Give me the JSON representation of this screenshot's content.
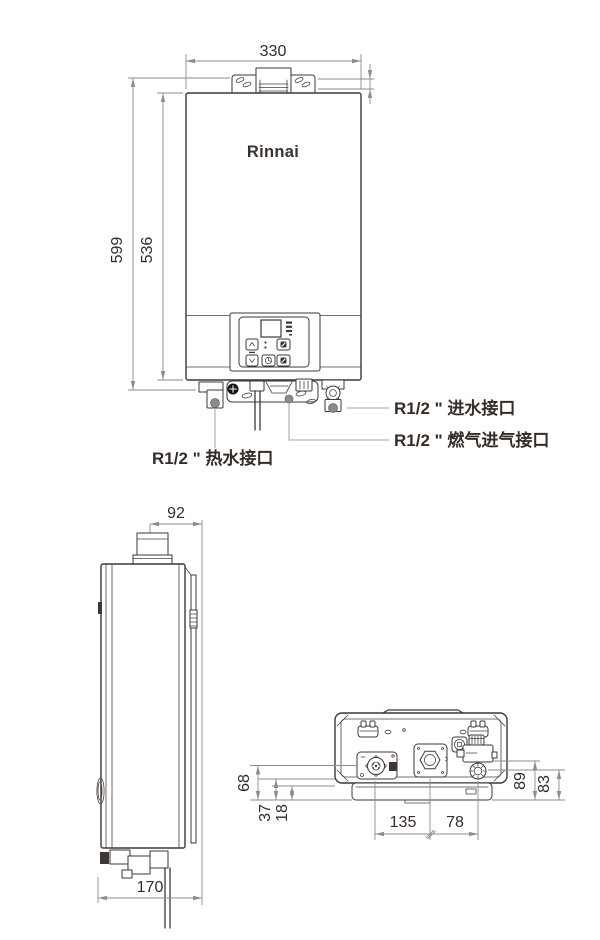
{
  "front": {
    "logo": "Rinnai",
    "dim_width_330": "330",
    "dim_height_599": "599",
    "dim_height_536": "536",
    "dim_top_10": "10",
    "label_inlet": "R1/2 \" 进水接口",
    "label_gas": "R1/2 \" 燃气进气接口",
    "label_hot": "R1/2 \" 热水接口"
  },
  "side": {
    "dim_92": "92",
    "dim_170": "170"
  },
  "bottom": {
    "dim_68": "68",
    "dim_37": "37",
    "dim_18": "18",
    "dim_135": "135",
    "dim_78": "78",
    "dim_89": "89",
    "dim_83": "83"
  },
  "control_panel": {
    "icons": [
      "up-arrow-icon",
      "down-arrow-icon",
      "clock-icon",
      "mode-icon",
      "priority-icon"
    ],
    "display_state": "blank"
  },
  "colors": {
    "outline": "#3F3734",
    "dimension_line": "#8F8C89",
    "leader_line": "#A3A09D",
    "text": "#352C27",
    "port_fill": "#8D8A88",
    "background": "#FFFFFF"
  }
}
